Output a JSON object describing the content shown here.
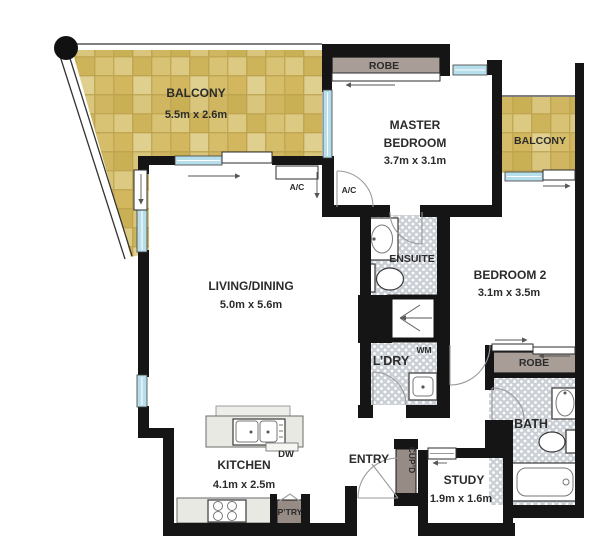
{
  "labels": {
    "balcony1": {
      "name": "BALCONY",
      "dims": "5.5m x 2.6m"
    },
    "balcony2": {
      "name": "BALCONY"
    },
    "master": {
      "line1": "MASTER",
      "line2": "BEDROOM",
      "dims": "3.7m x 3.1m"
    },
    "living": {
      "name": "LIVING/DINING",
      "dims": "5.0m x 5.6m"
    },
    "bedroom2": {
      "name": "BEDROOM 2",
      "dims": "3.1m x 3.5m"
    },
    "kitchen": {
      "name": "KITCHEN",
      "dims": "4.1m x 2.5m"
    },
    "study": {
      "name": "STUDY",
      "dims": "1.9m x 1.6m"
    },
    "entry": {
      "name": "ENTRY"
    },
    "ensuite": {
      "name": "ENSUITE"
    },
    "laundry": {
      "name": "L’DRY",
      "wm": "WM"
    },
    "bath": {
      "name": "BATH"
    },
    "robe_master": "ROBE",
    "robe_bedroom2": "ROBE",
    "pantry": "P’TRY",
    "cupboard": "CUP’D",
    "ac_unit": "A/C",
    "ac_cupboard": "A/C",
    "dishwasher": "DW"
  },
  "colors": {
    "wall": "#151515",
    "window": "#b7deeb",
    "robe": "#a89e97",
    "cabinet": "#968c85",
    "counter": "#e9e9e4",
    "door": "#9a9a9a",
    "text": "#2b2b2b",
    "balcony_tile": "#d5bc66",
    "wet_tile": "#cbd0d6"
  }
}
